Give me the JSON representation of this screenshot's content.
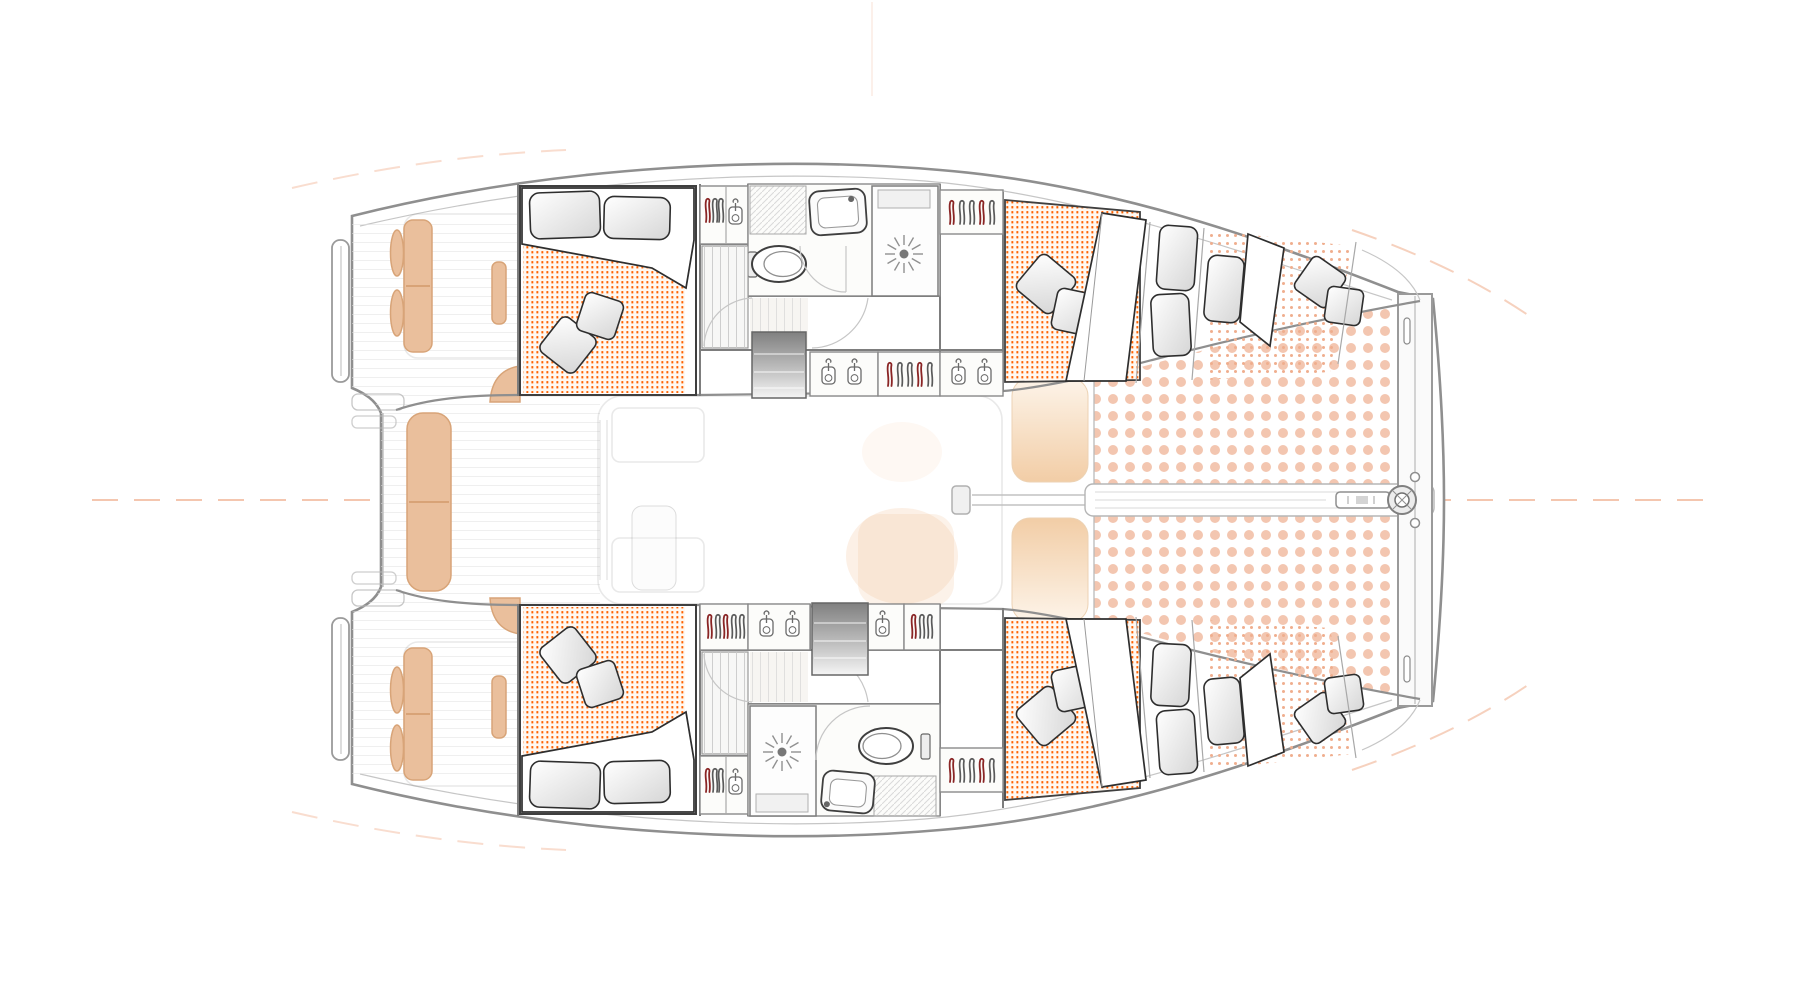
{
  "meta": {
    "title": "Sailing catamaran accommodation plan — top view, bow to the right",
    "type": "floor-plan",
    "subject": "catamaran interior layout"
  },
  "colors": {
    "background": "#ffffff",
    "hull_outline": "#8f8f8f",
    "accent_line": "#f0b394",
    "mattress_dot": "#ff6200",
    "bow_cushion_dot": "#efae8e",
    "trampoline_dot": "#f3c6b0",
    "cushion_fill": "#eabf9c",
    "cushion_stroke": "#d8a478",
    "hatch_warm": "#f2cda6",
    "hatch_warm_light": "#fdf4e9",
    "steps_dark": "#808080",
    "steps_light": "#f5f5f5"
  },
  "layout": {
    "bow_direction": "right",
    "hulls": 2,
    "double_cabins": 4,
    "bow_berths": 2,
    "bathrooms": 2
  },
  "port_hull": {
    "side": "top",
    "rooms": [
      "aft double cabin",
      "wardrobe",
      "WC with basin",
      "shower",
      "companionway stairs",
      "corridor lockers",
      "forward double cabin",
      "bow berth"
    ]
  },
  "starboard_hull": {
    "side": "bottom",
    "rooms": [
      "aft double cabin",
      "wardrobe",
      "shower",
      "WC with basin",
      "companionway stairs",
      "corridor lockers",
      "forward double cabin",
      "bow berth"
    ]
  },
  "center": {
    "aft": [
      "swim platforms",
      "cockpit bench cushions"
    ],
    "mid": [
      "saloon (faint outline)",
      "mast",
      "boom"
    ],
    "forward": [
      "two deck hatches",
      "anchor walkway",
      "trampoline netting",
      "forward crossbeam",
      "forestay fitting"
    ]
  }
}
